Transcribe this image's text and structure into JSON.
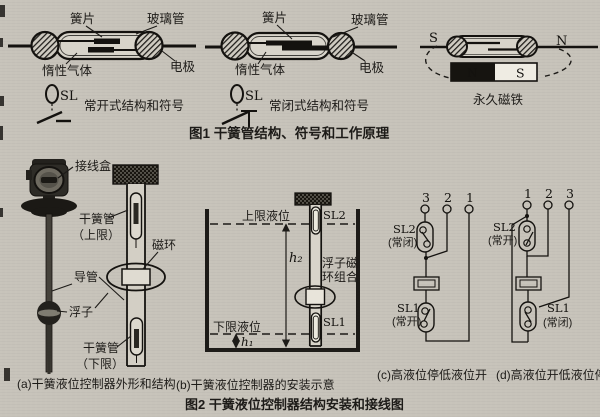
{
  "page": {
    "paper_color": "#c7c3ba",
    "ink_color": "#1d1b18"
  },
  "fig1": {
    "caption": "图1 干簧管结构、符号和工作原理",
    "open_switch": {
      "reed": "簧片",
      "glass": "玻璃管",
      "gas": "惰性气体",
      "electrode": "电极",
      "sl": "SL",
      "caption": "常开式结构和符号"
    },
    "closed_switch": {
      "reed": "簧片",
      "glass": "玻璃管",
      "gas": "惰性气体",
      "electrode": "电极",
      "sl": "SL",
      "caption": "常闭式结构和符号"
    },
    "magnet": {
      "pole_left": "S",
      "pole_right": "N",
      "bar_n": "N",
      "bar_s": "S",
      "caption": "永久磁铁"
    }
  },
  "fig2": {
    "caption": "图2 干簧液位控制器结构安装和接线图",
    "a": {
      "caption": "(a)干簧液位控制器外形和结构",
      "junction_box": "接线盒",
      "reed_upper_l1": "干簧管",
      "reed_upper_l2": "（上限）",
      "ring": "磁环",
      "tube": "导管",
      "float": "浮子",
      "reed_lower_l1": "干簧管",
      "reed_lower_l2": "（下限）"
    },
    "b": {
      "caption": "(b)干簧液位控制器的安装示意",
      "upper_level": "上限液位",
      "lower_level": "下限液位",
      "sl2": "SL2",
      "sl1": "SL1",
      "float_ring_l1": "浮子磁",
      "float_ring_l2": "环组合",
      "h2": "h₂",
      "h1": "h₁"
    },
    "c": {
      "caption": "(c)高液位停低液位开",
      "terminals": [
        "3",
        "2",
        "1"
      ],
      "sl2": "SL2",
      "sl2_mode": "(常闭)",
      "sl1": "SL1",
      "sl1_mode": "(常开)"
    },
    "d": {
      "caption": "(d)高液位开低液位停",
      "terminals": [
        "1",
        "2",
        "3"
      ],
      "sl2": "SL2",
      "sl2_mode": "(常开)",
      "sl1": "SL1",
      "sl1_mode": "(常闭)"
    }
  }
}
